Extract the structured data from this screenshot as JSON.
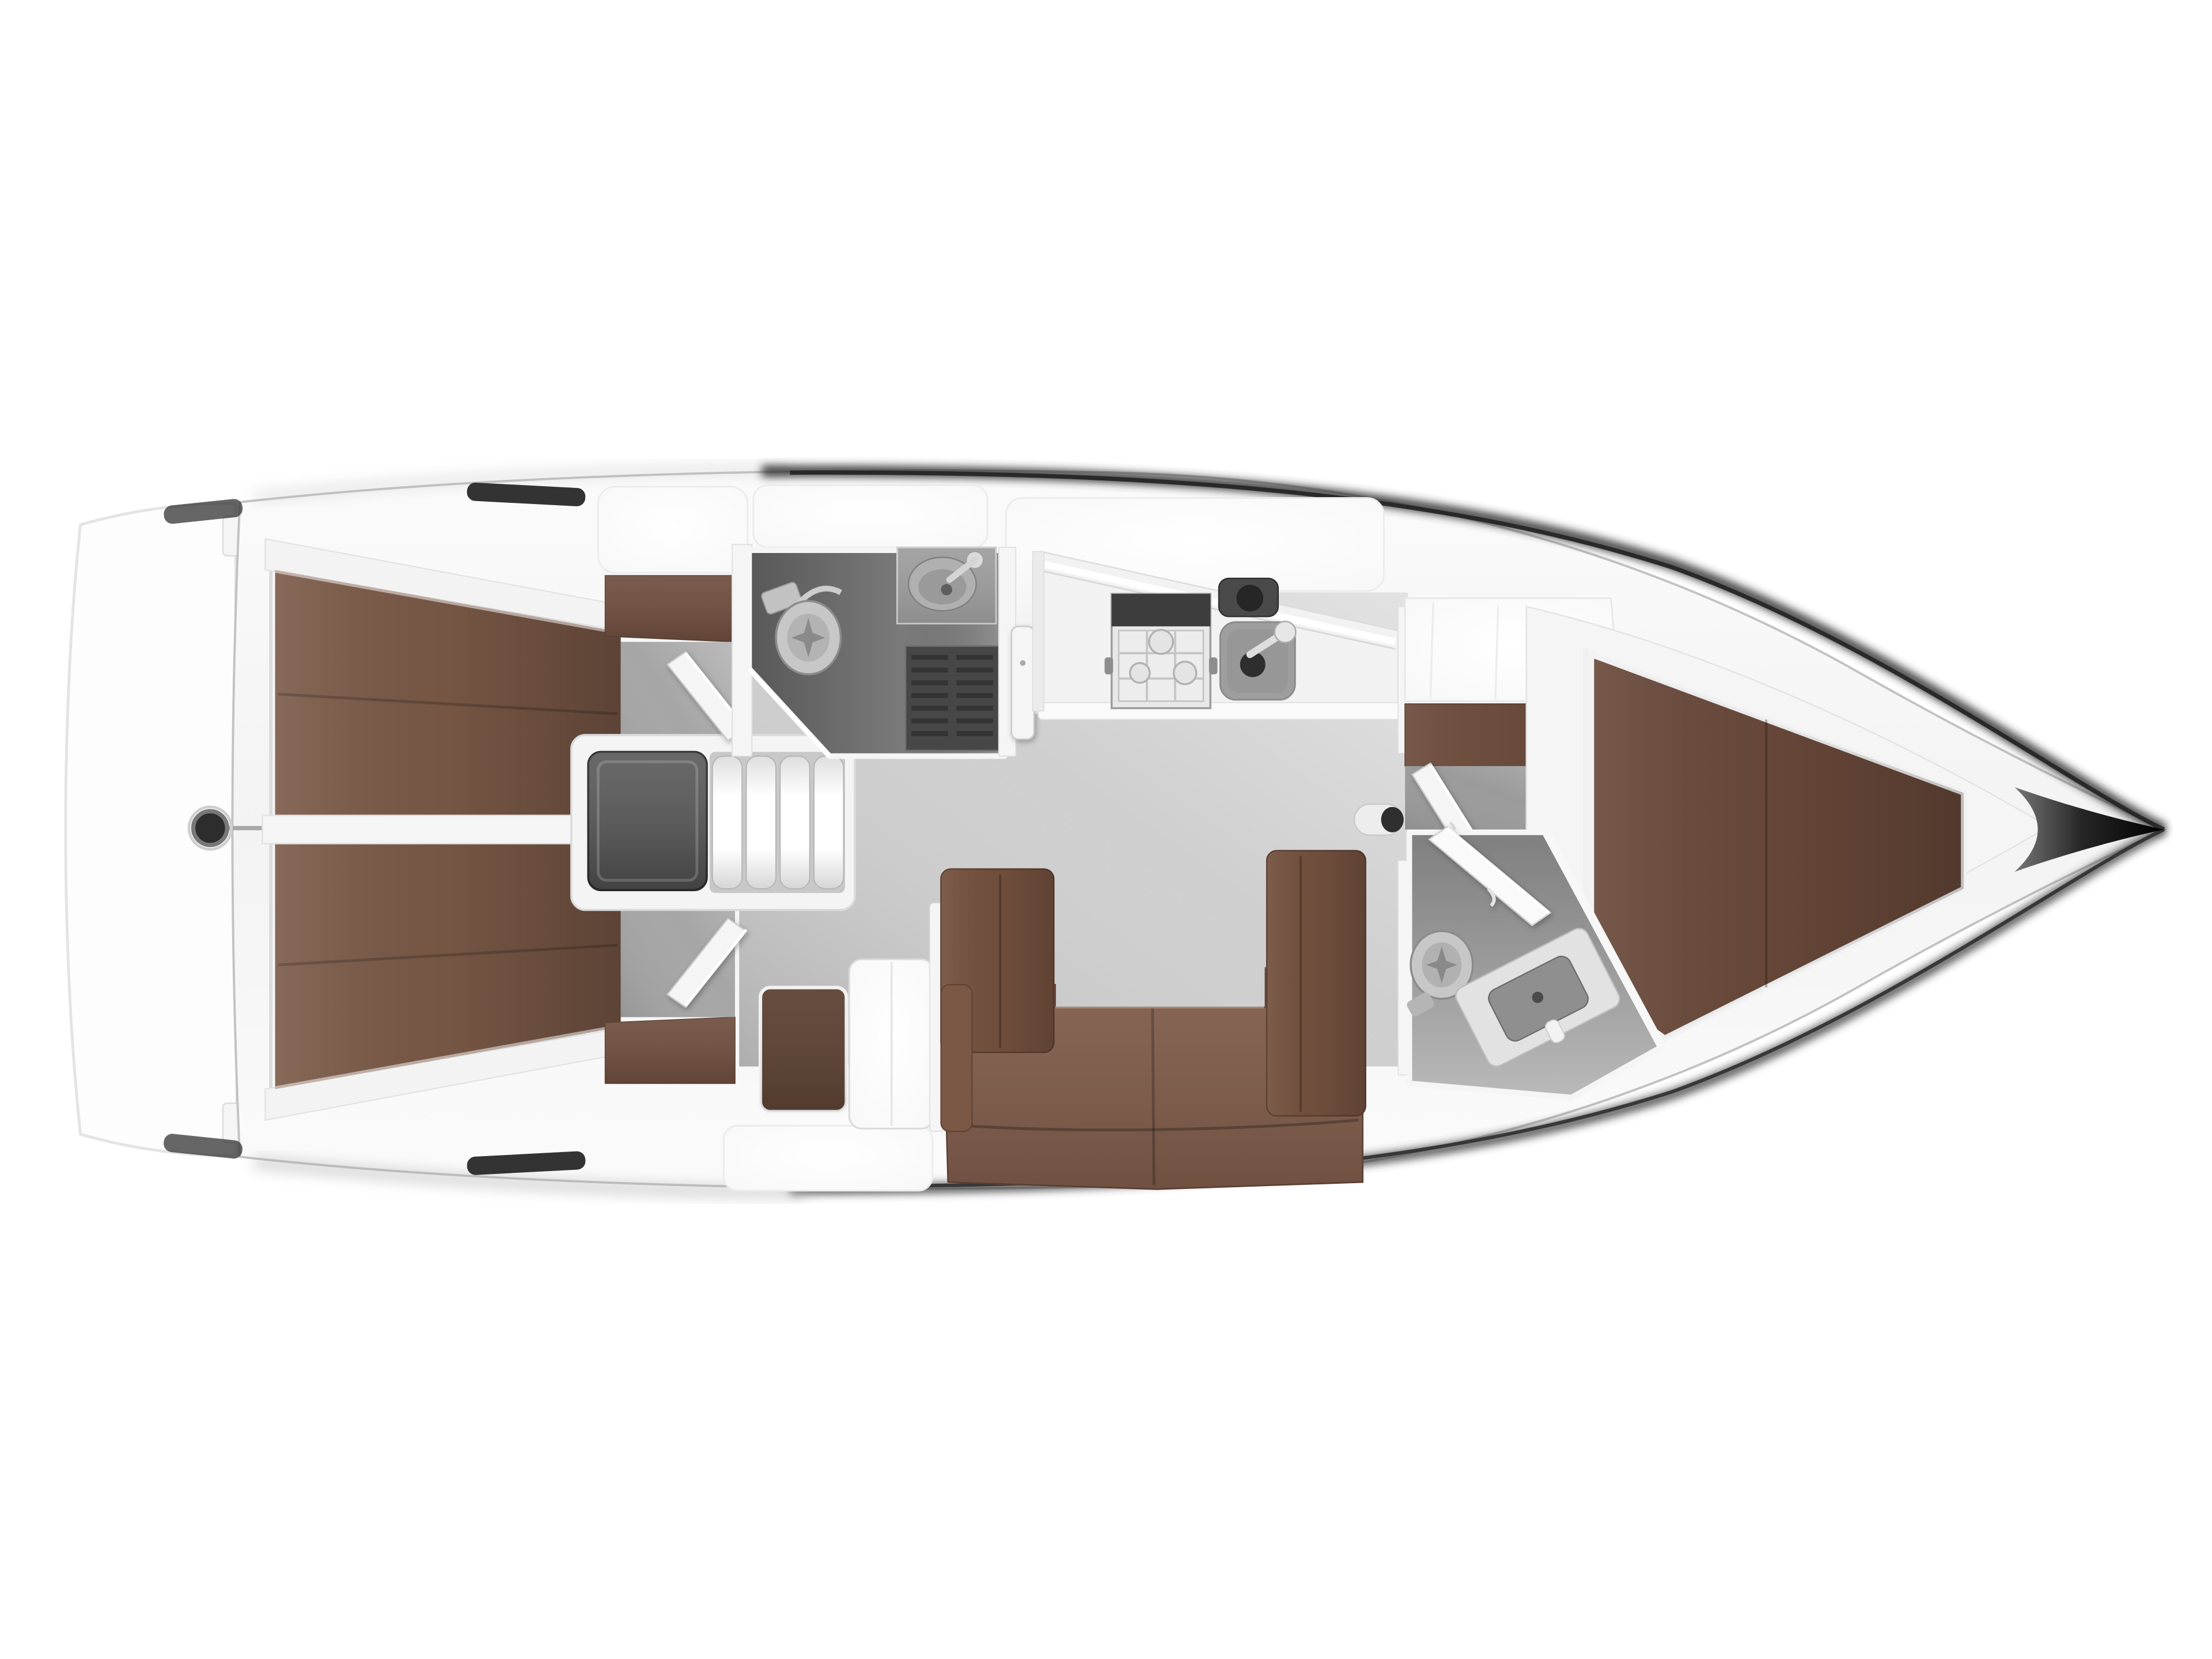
{
  "scene": {
    "subject": "sailboat-interior-floor-plan-top-view",
    "bow_direction": "right",
    "stern_direction": "left"
  },
  "palette": {
    "background": "#ffffff",
    "deck_white": "#f8f8f8",
    "panel_white": "#ffffff",
    "wall_white": "#f5f5f5",
    "shelf_white": "#f3f3f3",
    "line_gray": "#dcdcdc",
    "hull_edge_dark": "#2e2e2e",
    "hull_edge_soft": "#aeaeae",
    "bow_dark": "#0a0a0a",
    "slot_dark": "#333333",
    "floor_light": "#cfcfcf",
    "floor_cabin": "#a6a6a6",
    "floor_passage": "#9b9b9b",
    "head_floor": "#7a7a7a",
    "head_floor_fwd": "#a3a3a3",
    "grate_dark": "#474747",
    "engine_gray": "#545454",
    "steel_light": "#e8e8e8",
    "fixture_gray": "#c7c7c7",
    "basin_gray": "#9e9e9e",
    "berth_brown": "#7a5947",
    "berth_brown_fwd": "#69493a",
    "sofa_brown": "#7f5b49",
    "sofa_back_brown": "#73503e",
    "wardrobe_brown": "#6f4e3e",
    "locker_brown": "#5c4133"
  },
  "areas": {
    "stern_platform": {
      "label": "stern-swim-platform"
    },
    "aft_cabin_top": {
      "label": "aft-double-cabin-port"
    },
    "aft_cabin_bottom": {
      "label": "aft-double-cabin-starboard"
    },
    "engine_box": {
      "label": "engine-compartment"
    },
    "companionway": {
      "label": "companionway-steps",
      "treads": 4
    },
    "aft_head": {
      "label": "aft-head-with-shower"
    },
    "galley": {
      "label": "galley",
      "burners": 3,
      "sinks": 2
    },
    "saloon": {
      "label": "saloon-u-shaped-settee"
    },
    "forward_head": {
      "label": "forward-head"
    },
    "forward_cabin": {
      "label": "forward-v-berth-cabin"
    },
    "bow": {
      "label": "bow-tip"
    }
  },
  "fixtures": {
    "toilets": 2,
    "washbasins": 2,
    "galley_sinks": 2,
    "stove_burners": 3,
    "shower_grates": 1,
    "deck_hatches": 4,
    "deck_vents": 4,
    "doors": 5,
    "step_treads": 4,
    "rudder_fitting": 1,
    "mast_post": 1
  }
}
